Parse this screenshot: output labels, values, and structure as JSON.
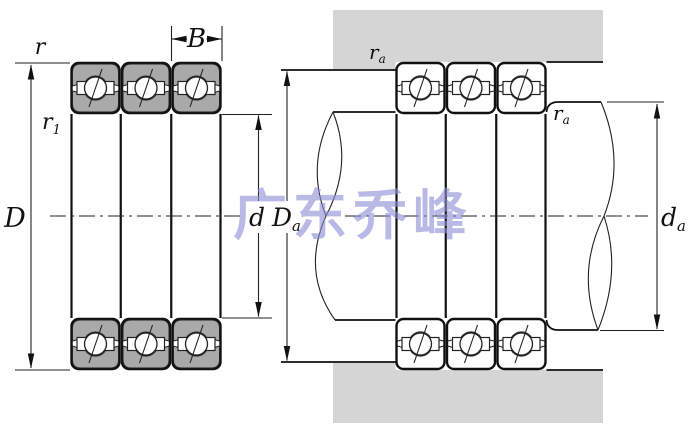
{
  "watermark": {
    "text": "广东乔峰",
    "color": "#8f8fd8"
  },
  "colors": {
    "bearing_shade": "#a9a9a9",
    "housing_shade": "#d5d5d5",
    "line": "#111111",
    "background": "#ffffff"
  },
  "left_view": {
    "labels": {
      "r": {
        "main": "r",
        "sub": ""
      },
      "r1": {
        "main": "r",
        "sub": "1"
      },
      "B": {
        "main": "B",
        "sub": ""
      },
      "D": {
        "main": "D",
        "sub": ""
      },
      "d": {
        "main": "d",
        "sub": ""
      }
    }
  },
  "right_view": {
    "labels": {
      "ra_housing": {
        "main": "r",
        "sub": "a"
      },
      "ra_shaft": {
        "main": "r",
        "sub": "a"
      },
      "Da": {
        "main": "D",
        "sub": "a"
      },
      "da": {
        "main": "d",
        "sub": "a"
      }
    }
  }
}
